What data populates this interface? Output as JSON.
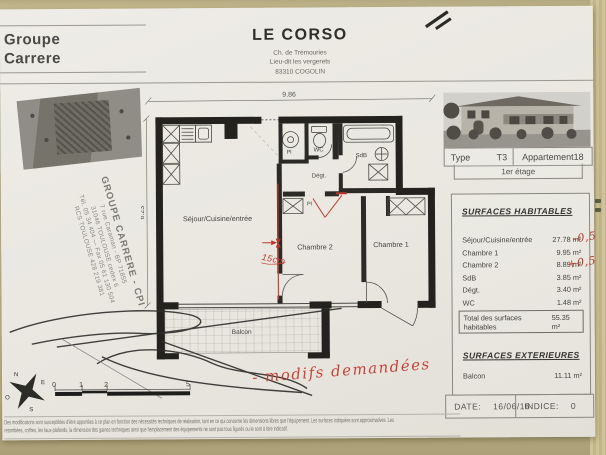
{
  "header": {
    "company_line1": "Groupe",
    "company_line2": "Carrere",
    "title": "LE CORSO",
    "address1": "Ch. de Trémouries",
    "address2": "Lieu-dit les vergerets",
    "address3": "83310 COGOLIN"
  },
  "stamp": {
    "l1": "GROUPE CARRERE - CPI",
    "l2": "7 rue Caraman - BP 71855",
    "l3": "31046 TOULOUSE cedex 6",
    "l4": "Tél. 05 34 404 — Fax 05 61 130 504",
    "l5": "RCS TOULOUSE 428 219 381"
  },
  "plan": {
    "dim_width": "9.86",
    "dim_height": "6.23",
    "room_sejour": "Séjour/Cuisine/entrée",
    "room_chambre2": "Chambre 2",
    "room_chambre1": "Chambre 1",
    "room_wc": "WC",
    "room_sdb": "SdB",
    "room_degt": "Dégt.",
    "room_pl1": "Pl",
    "room_pl2": "Pl",
    "room_balcon": "Balcon",
    "note_wall": "15cm",
    "note_modifs": "- modifs demandées",
    "scale": {
      "t0": "0",
      "t1": "1",
      "t2": "2",
      "t5": "5"
    },
    "compass": {
      "n": "N",
      "e": "E",
      "s": "S",
      "o": "O"
    }
  },
  "panel": {
    "type_label": "Type",
    "type_value": "T3",
    "apt_label": "Appartement",
    "apt_value": "18",
    "floor": "1er étage",
    "hab_title": "SURFACES HABITABLES",
    "rows": [
      {
        "label": "Séjour/Cuisine/entrée",
        "value": "27.78 m²",
        "note": "-0,5"
      },
      {
        "label": "Chambre 1",
        "value": "9.95 m²"
      },
      {
        "label": "Chambre 2",
        "value": "8.89 m²",
        "note": "+0,5"
      },
      {
        "label": "SdB",
        "value": "3.85 m²"
      },
      {
        "label": "Dégt.",
        "value": "3.40 m²"
      },
      {
        "label": "WC",
        "value": "1.48 m²"
      }
    ],
    "total_label": "Total des surfaces habitables",
    "total_value": "55.35 m²",
    "ext_title": "SURFACES EXTERIEURES",
    "ext_label": "Balcon",
    "ext_value": "11.11 m²",
    "date_label": "DATE:",
    "date_value": "16/06/16",
    "indice_label": "INDICE:",
    "indice_value": "0"
  },
  "disclaimer": {
    "line1": "Des modifications sont susceptibles d'être apportées à ce plan en fonction des nécessités techniques de réalisation, tant en ce qui concerne les dimensions libres que l'équipement. Les surfaces indiquées sont approximatives. Les",
    "line2": "retombées, coffres, les faux-plafonds, la dimension des gaines techniques ainsi que l'emplacement des équipements ne sont pas tous figurés ou le sont à titre indicatif."
  }
}
